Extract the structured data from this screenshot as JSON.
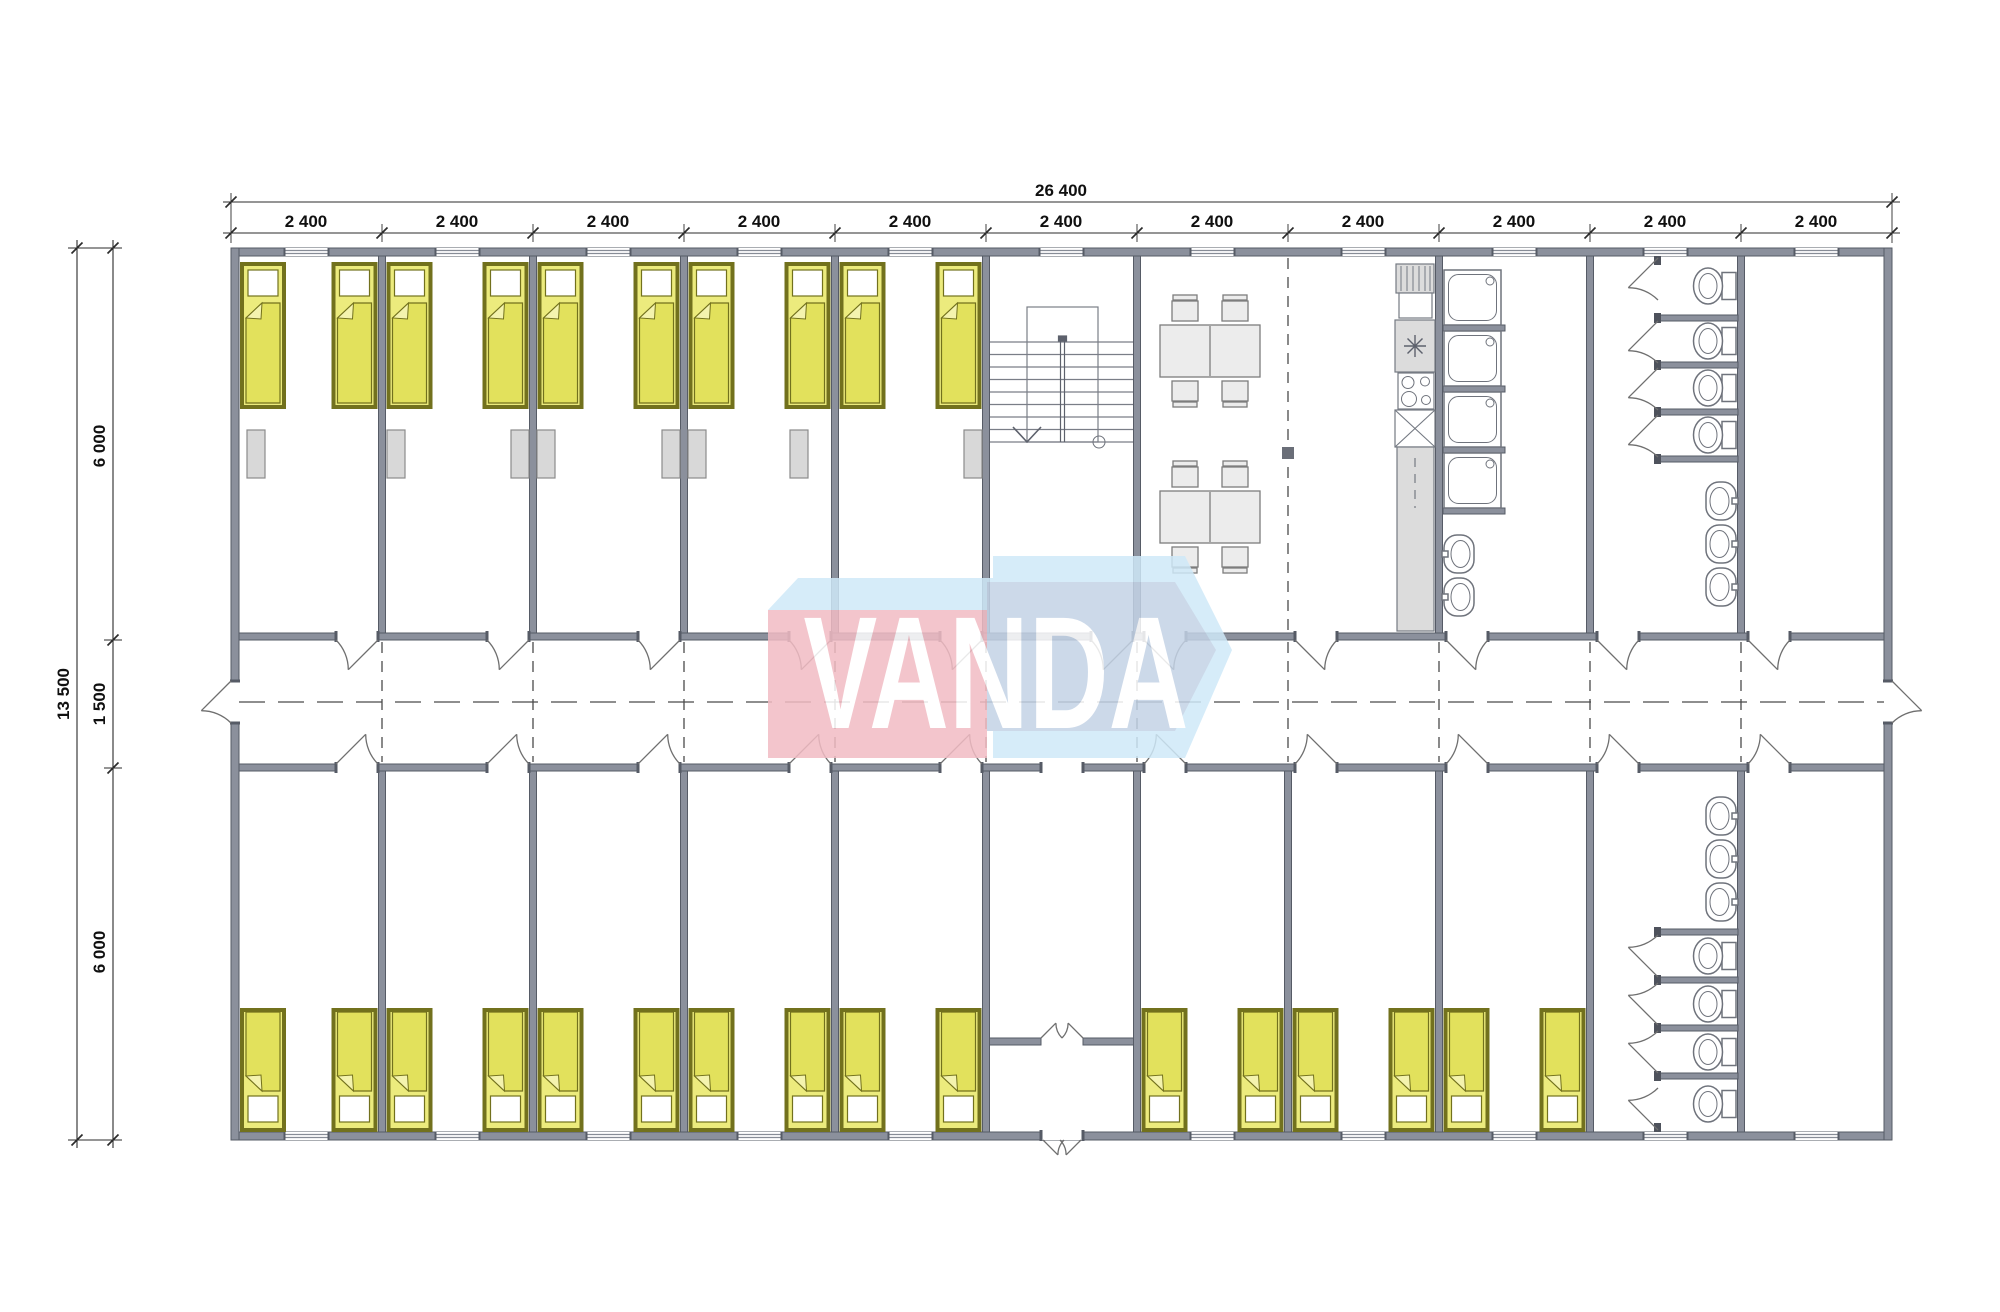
{
  "page": {
    "background": "#ffffff",
    "description": "Architectural floor plan of a modular dormitory container building with bedrooms, stair hall, dining room, kitchen, shower room, toilet rooms and central corridor"
  },
  "dimensions": {
    "top_total": "26 400",
    "top_segments": [
      "2 400",
      "2 400",
      "2 400",
      "2 400",
      "2 400",
      "2 400",
      "2 400",
      "2 400",
      "2 400",
      "2 400",
      "2 400"
    ],
    "left_total": "13 500",
    "left_upper": "6 000",
    "left_corridor": "1 500",
    "left_lower": "6 000"
  },
  "watermark": {
    "text": "VANDA"
  },
  "colors": {
    "wall": "#8b909c",
    "wall_stroke": "#565b66",
    "thin": "#7a7e87",
    "fixture": "#6f737c",
    "furniture": "#ececec",
    "nightstand": "#d8d8d8",
    "kitchen": "#dcdcdc",
    "bed_yellow": "#eceb7d",
    "bed_blanket": "#e2e15c",
    "bed_fold": "#f4f3ae",
    "bed_olive": "#72711d",
    "dash": "#4a4a4a",
    "dim": "#2b2b2b",
    "wm_red": "#f2bcc4",
    "wm_pale": "#cfe9f8",
    "wm_blue": "#c4d3e6",
    "wm_text": "#ffffff"
  }
}
